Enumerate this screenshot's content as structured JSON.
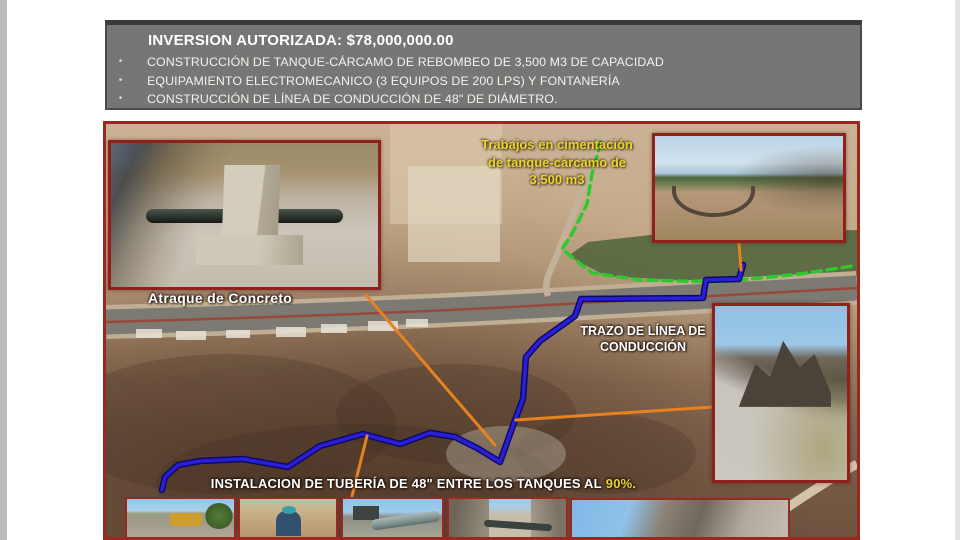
{
  "slide": {
    "header": {
      "title": "INVERSION AUTORIZADA: $78,000,000.00",
      "bullet_char": "•",
      "bullets": [
        "CONSTRUCCIÓN DE TANQUE-CÁRCAMO DE REBOMBEO DE 3,500 M3 DE CAPACIDAD",
        "EQUIPAMIENTO ELECTROMECANICO (3 EQUIPOS DE 200 LPS) Y FONTANERÍA",
        "CONSTRUCCIÓN DE LÍNEA DE CONDUCCIÓN DE 48\" DE DIÁMETRO."
      ]
    },
    "map": {
      "label_trabajos_line1": "Trabajos en cimentación",
      "label_trabajos_line2": "de tanque-cárcamo de",
      "label_trabajos_line3": "3,500 m3",
      "label_atraque": "Atraque de Concreto",
      "label_trazo_line1": "TRAZO DE LÍNEA DE",
      "label_trazo_line2": "CONDUCCIÓN",
      "label_instalacion": "INSTALACION DE TUBERÍA DE 48\" ENTRE LOS TANQUES AL",
      "label_instalacion_pct": "90%.",
      "annotations": {
        "blue_line_meaning": "TRAZO DE LÍNEA DE CONDUCCIÓN",
        "progress_percent": "90%"
      }
    },
    "colors": {
      "header_bg": "#777674",
      "border_red": "#9a281e",
      "line_blue": "#2a1fd6",
      "line_green": "#2ec92e",
      "line_orange": "#e8811f",
      "text_yellow": "#e9d62e"
    }
  }
}
